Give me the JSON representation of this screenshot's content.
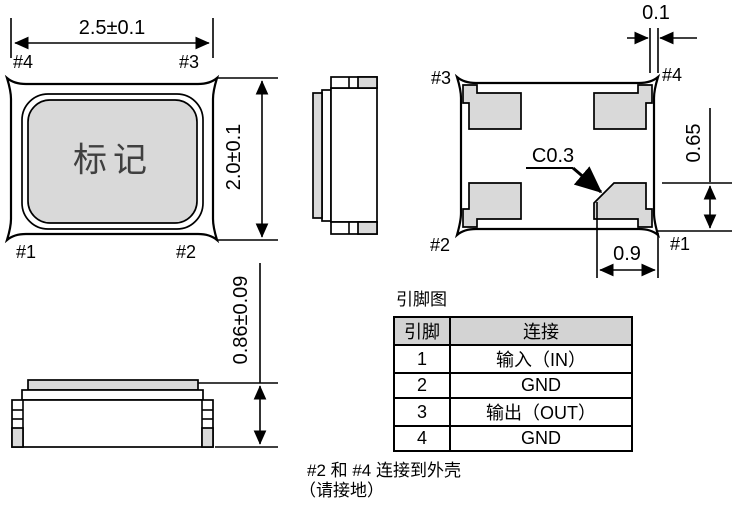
{
  "top_view": {
    "marking_label": "标记",
    "width_dim": "2.5±0.1",
    "height_dim": "2.0±0.1",
    "pin_top_left": "#4",
    "pin_top_right": "#3",
    "pin_bottom_left": "#1",
    "pin_bottom_right": "#2"
  },
  "bottom_view": {
    "pin_top_left": "#3",
    "pin_top_right": "#4",
    "pin_bottom_left": "#2",
    "pin_bottom_right": "#1",
    "corner_dim": "0.1",
    "pad_height_dim": "0.65",
    "pad_width_dim": "0.9",
    "chamfer_label": "C0.3"
  },
  "front_view": {
    "height_dim": "0.86±0.09"
  },
  "pin_table": {
    "title": "引脚图",
    "col_pin": "引脚",
    "col_connection": "连接",
    "rows": [
      {
        "pin": "1",
        "connection": "输入（IN）"
      },
      {
        "pin": "2",
        "connection": "GND"
      },
      {
        "pin": "3",
        "connection": "输出（OUT）"
      },
      {
        "pin": "4",
        "connection": "GND"
      }
    ]
  },
  "note": {
    "line1": "#2 和 #4 连接到外壳",
    "line2": "（请接地）"
  },
  "colors": {
    "line": "#000000",
    "fill_gray": "#d9d9d9",
    "table_header_bg": "#d3d3d3",
    "marking_text": "#404040"
  }
}
